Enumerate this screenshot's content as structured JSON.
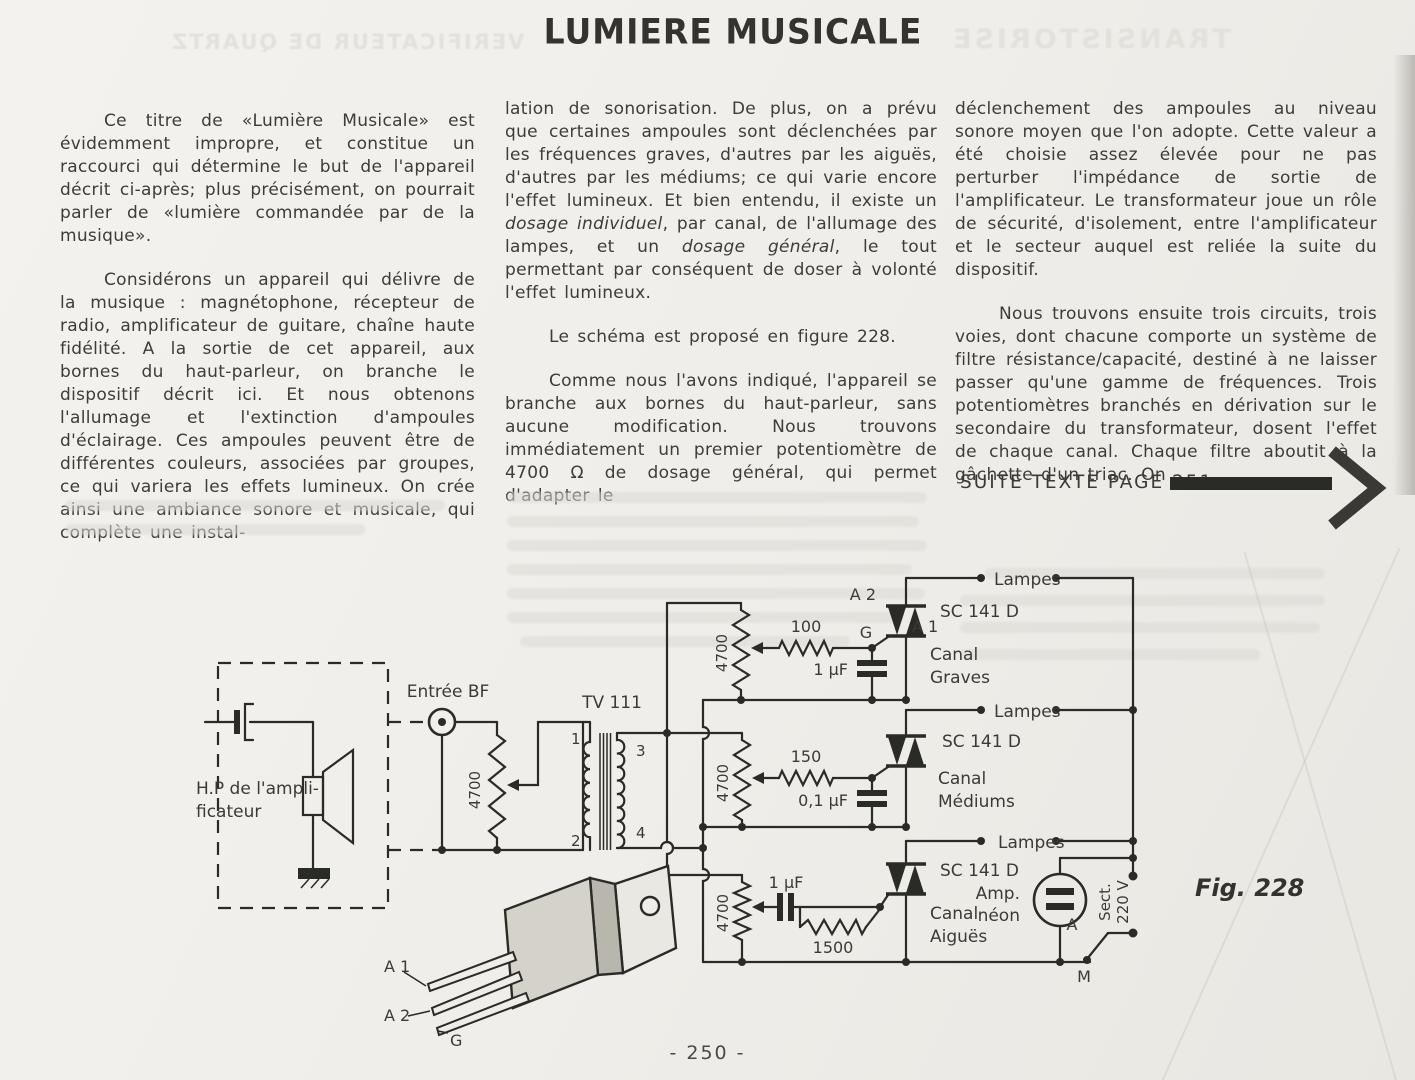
{
  "title": "LUMIERE MUSICALE",
  "page_number": "- 250 -",
  "ghost_headlines": {
    "left": "VERIFICATEUR DE QUARTZ",
    "right": "TRANSISTORISE"
  },
  "columns": {
    "col1": {
      "p1": "Ce titre de «Lumière Musicale» est évidemment impropre, et constitue un raccourci qui détermine le but de l'appareil décrit ci-après; plus précisément, on pourrait parler de «lumière commandée par de la musique».",
      "p2": "Considérons un appareil qui délivre de la musique : magnétophone, récepteur de radio, amplificateur de guitare, chaîne haute fidélité. A la sortie de cet appareil, aux bornes du haut-parleur, on branche le dispositif décrit ici. Et nous obtenons l'allumage et l'extinction d'ampoules d'éclairage. Ces ampoules peuvent être de différentes couleurs, associées par groupes, ce qui variera les effets lumineux. On crée ainsi une ambiance sonore et musicale, qui complète une instal-"
    },
    "col2": {
      "p1_parts": [
        "lation de sonorisation. De plus, on a prévu que certaines ampoules sont déclenchées par les fréquences graves, d'autres par les aiguës, d'autres par les médiums; ce qui varie encore l'effet lumineux. Et bien entendu, il existe un ",
        "dosage individuel",
        ", par canal, de l'allumage des lampes, et un ",
        "dosage général",
        ", le tout permettant par conséquent de doser à volonté l'effet lumineux."
      ],
      "p2": "Le schéma est proposé en figure 228.",
      "p3": "Comme nous l'avons indiqué, l'appareil se branche aux bornes du haut-parleur, sans aucune modification. Nous trouvons immédiatement un premier potentiomètre de 4700 Ω de dosage général, qui permet d'adapter le"
    },
    "col3": {
      "p1": "déclenchement des ampoules au niveau sonore moyen que l'on adopte. Cette valeur a été choisie assez élevée pour ne pas perturber l'impédance de sortie de l'amplificateur. Le transformateur joue un rôle de sécurité, d'isolement, entre l'amplificateur et le secteur auquel est reliée la suite du dispositif.",
      "p2": "Nous trouvons ensuite trois circuits, trois voies, dont chacune comporte un système de filtre résistance/capacité, destiné à ne laisser passer qu'une gamme de fréquences. Trois potentiomètres branchés en dérivation sur le secondaire du transformateur, dosent l'effet de chaque canal. Chaque filtre aboutit à la gâchette d'un triac. On",
      "suite_label": "SUITE TEXTE PAGE 251"
    }
  },
  "schematic": {
    "caption": "Fig. 228",
    "input": {
      "jack_label": "Entrée BF",
      "speaker_label_1": "H.P de l'ampli-",
      "speaker_label_2": "ficateur",
      "pot": "4700"
    },
    "transformer": {
      "name": "TV 111",
      "pin1": "1",
      "pin2": "2",
      "pin3": "3",
      "pin4": "4"
    },
    "channels": [
      {
        "name_1": "Canal",
        "name_2": "Graves",
        "pot": "4700",
        "series_res": "100",
        "cap": "1 µF",
        "triac": "SC 141 D",
        "lamps": "Lampes",
        "a2": "A 2",
        "a1": "A 1",
        "gate": "G"
      },
      {
        "name_1": "Canal",
        "name_2": "Médiums",
        "pot": "4700",
        "series_res": "150",
        "cap": "0,1 µF",
        "triac": "SC 141 D",
        "lamps": "Lampes"
      },
      {
        "name_1": "Canal",
        "name_2": "Aiguës",
        "pot": "4700",
        "series_cap": "1 µF",
        "gate_res": "1500",
        "triac": "SC 141 D",
        "lamps": "Lampes"
      }
    ],
    "mains": {
      "neon_1": "Amp.",
      "neon_2": "néon",
      "sect_1": "Sect.",
      "sect_2": "220 V",
      "switch_a": "A",
      "switch_m": "M"
    },
    "package": {
      "lead_a1": "A 1",
      "lead_a2": "A 2",
      "lead_g": "G"
    }
  }
}
